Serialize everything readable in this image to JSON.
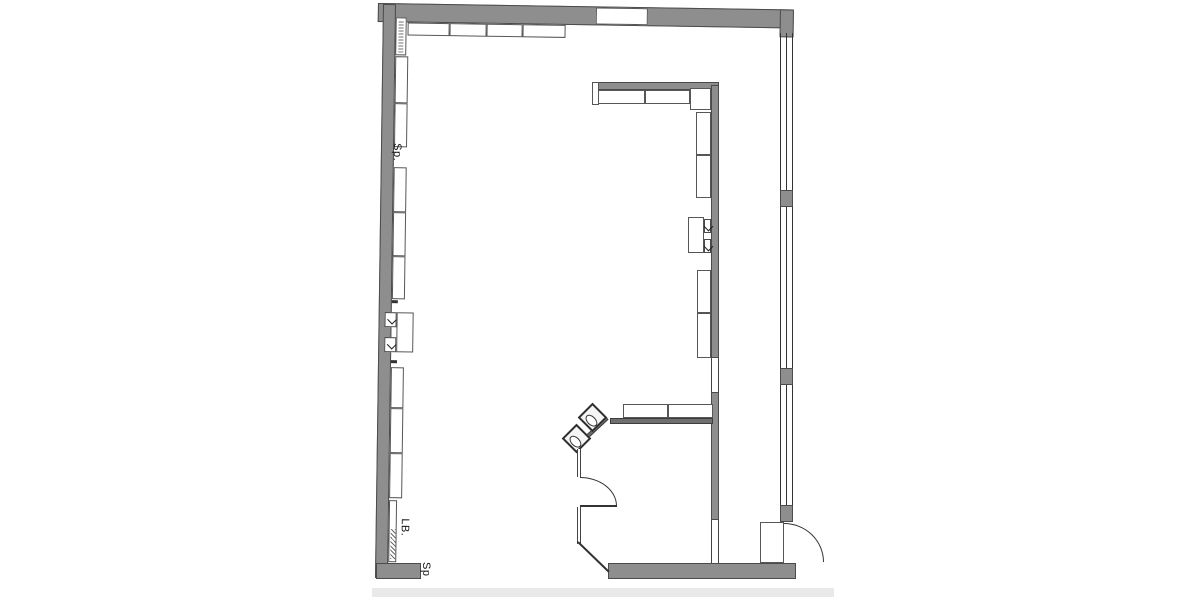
{
  "plan": {
    "labels": {
      "sink_upper": "Sp.",
      "lb": "LB.",
      "sink_lower": "Sp"
    },
    "colors": {
      "paper": "#ffffff",
      "wall_fill": "#8e8e8e",
      "wall_edge": "#4b4b4b",
      "line": "#333333",
      "counter_fill": "#6f6f6f",
      "page_edge": "#e9e9e9"
    },
    "icons": {
      "door_swing": "quarter-arc",
      "washbasin": "rotated-square-with-oval-bowl",
      "direction_arrow": "small-chevron",
      "illegible_text": "dotted-vertical-strip",
      "window": "double-line-with-mullions"
    }
  }
}
